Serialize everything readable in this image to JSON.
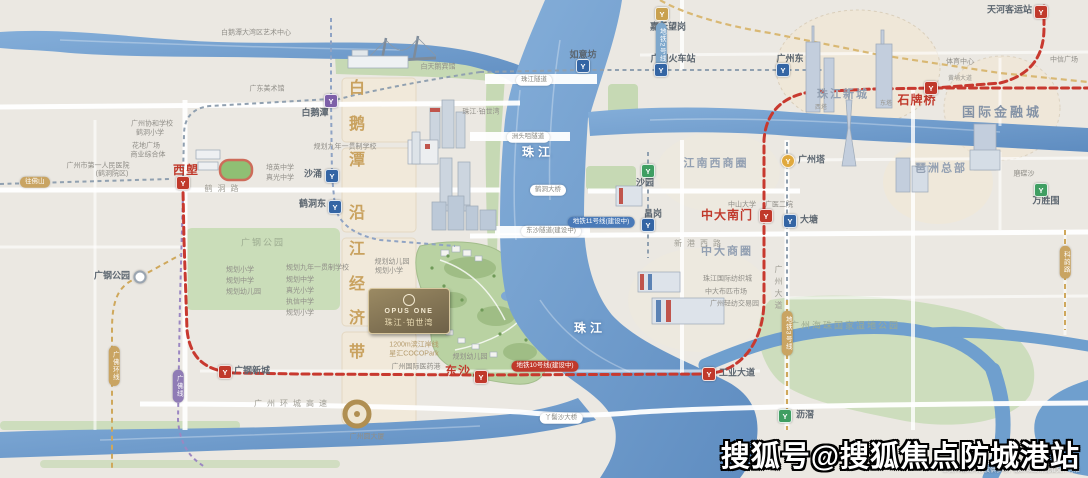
{
  "watermark": {
    "text": "搜狐号@搜狐焦点防城港站",
    "disclaimer": "本资料相关内容仅供参考，最终以政府批准文件为准"
  },
  "project": {
    "logo_latin": "OPUS ONE",
    "logo_cn": "珠江·铂世湾"
  },
  "icon_glyph": "Y",
  "colors": {
    "metro_red": "#c0392b",
    "metro_blue": "#3465a4",
    "metro_gold": "#c9a14e",
    "metro_purple": "#7d5fa8",
    "river_blue": "#6f9cce",
    "park_green": "#c6d9b4",
    "district_gold": "#c9a25f"
  },
  "stations": [
    {
      "x": 183,
      "y": 183,
      "c": "ic-red",
      "n": "station-icon-xilang"
    },
    {
      "x": 225,
      "y": 372,
      "c": "ic-red",
      "n": "station-icon-guanggang-xincheng"
    },
    {
      "x": 481,
      "y": 377,
      "c": "ic-red",
      "n": "station-icon-dongsha"
    },
    {
      "x": 709,
      "y": 374,
      "c": "ic-red",
      "n": "station-icon-gongye-dadao"
    },
    {
      "x": 766,
      "y": 216,
      "c": "ic-red",
      "n": "station-icon-zhongda-nanmen"
    },
    {
      "x": 931,
      "y": 88,
      "c": "ic-red",
      "n": "station-icon-shipaiqiao"
    },
    {
      "x": 1041,
      "y": 12,
      "c": "ic-red",
      "n": "station-icon-tianhe-keyunzhan"
    },
    {
      "x": 331,
      "y": 101,
      "c": "ic-purple",
      "n": "station-icon-baietan"
    },
    {
      "x": 332,
      "y": 176,
      "c": "ic-blue",
      "n": "station-icon-shachong"
    },
    {
      "x": 335,
      "y": 207,
      "c": "ic-blue",
      "n": "station-icon-hedongdong"
    },
    {
      "x": 583,
      "y": 66,
      "c": "ic-blue",
      "n": "station-icon-ruyifang"
    },
    {
      "x": 661,
      "y": 70,
      "c": "ic-blue",
      "n": "station-icon-guangzhou-railway"
    },
    {
      "x": 662,
      "y": 14,
      "c": "ic-gold",
      "n": "station-icon-jiahewanggang"
    },
    {
      "x": 783,
      "y": 70,
      "c": "ic-blue",
      "n": "station-icon-guangzhoudong"
    },
    {
      "x": 788,
      "y": 161,
      "c": "ic-yellow",
      "n": "station-icon-canton-tower"
    },
    {
      "x": 790,
      "y": 221,
      "c": "ic-blue",
      "n": "station-icon-datang"
    },
    {
      "x": 648,
      "y": 171,
      "c": "ic-green",
      "n": "station-icon-shayuan"
    },
    {
      "x": 648,
      "y": 225,
      "c": "ic-blue",
      "n": "station-icon-changgang"
    },
    {
      "x": 785,
      "y": 416,
      "c": "ic-green",
      "n": "station-icon-lijiao"
    },
    {
      "x": 1041,
      "y": 190,
      "c": "ic-green",
      "n": "station-icon-wanshengwei"
    },
    {
      "x": 140,
      "y": 277,
      "c": "ic-ring",
      "n": "station-icon-guanggang-park"
    }
  ],
  "labels": [
    {
      "t": "西塱",
      "x": 186,
      "y": 170,
      "c": "sta-red",
      "n": "station-label-xilang"
    },
    {
      "t": "广钢新城",
      "x": 234,
      "y": 371,
      "c": "sta",
      "a": "l",
      "n": "station-label-guanggang-xincheng"
    },
    {
      "t": "东沙",
      "x": 471,
      "y": 371,
      "c": "sta-red",
      "a": "r",
      "n": "station-label-dongsha"
    },
    {
      "t": "工业大道",
      "x": 719,
      "y": 373,
      "c": "sta",
      "a": "l",
      "n": "station-label-gongye-dadao"
    },
    {
      "t": "中大南门",
      "x": 753,
      "y": 215,
      "c": "sta-red",
      "a": "r",
      "n": "station-label-zhongda-nanmen"
    },
    {
      "t": "石牌桥",
      "x": 917,
      "y": 100,
      "c": "sta-red",
      "n": "station-label-shipaiqiao"
    },
    {
      "t": "天河客运站",
      "x": 1032,
      "y": 10,
      "c": "sta",
      "a": "r",
      "n": "station-label-tianhe-keyunzhan"
    },
    {
      "t": "白鹅潭",
      "x": 315,
      "y": 113,
      "c": "sta",
      "n": "station-label-baietan"
    },
    {
      "t": "沙涌",
      "x": 322,
      "y": 174,
      "c": "sta",
      "a": "r",
      "n": "station-label-shachong"
    },
    {
      "t": "鹤洞东",
      "x": 326,
      "y": 204,
      "c": "sta",
      "a": "r",
      "n": "station-label-hedongdong"
    },
    {
      "t": "如意坊",
      "x": 583,
      "y": 55,
      "c": "sta",
      "n": "station-label-ruyifang"
    },
    {
      "t": "广州火车站",
      "x": 673,
      "y": 59,
      "c": "sta",
      "n": "station-label-guangzhou-railway"
    },
    {
      "t": "嘉禾望岗",
      "x": 668,
      "y": 27,
      "c": "sta",
      "n": "station-label-jiahewanggang"
    },
    {
      "t": "广州东",
      "x": 790,
      "y": 59,
      "c": "sta",
      "n": "station-label-guangzhoudong"
    },
    {
      "t": "广州塔",
      "x": 798,
      "y": 160,
      "c": "sta",
      "a": "l",
      "n": "station-label-canton-tower"
    },
    {
      "t": "大塘",
      "x": 800,
      "y": 220,
      "c": "sta",
      "a": "l",
      "n": "station-label-datang"
    },
    {
      "t": "沙园",
      "x": 645,
      "y": 183,
      "c": "sta",
      "n": "station-label-shayuan"
    },
    {
      "t": "昌岗",
      "x": 653,
      "y": 214,
      "c": "sta",
      "n": "station-label-changgang"
    },
    {
      "t": "沥滘",
      "x": 796,
      "y": 415,
      "c": "sta",
      "a": "l",
      "n": "station-label-lijiao"
    },
    {
      "t": "万胜围",
      "x": 1046,
      "y": 201,
      "c": "sta",
      "n": "station-label-wanshengwei"
    },
    {
      "t": "广钢公园",
      "x": 130,
      "y": 276,
      "c": "sta",
      "a": "r",
      "n": "station-label-guanggang-park"
    },
    {
      "t": "江南西商圈",
      "x": 716,
      "y": 164,
      "c": "area-sm",
      "n": "district-label-jiangnanxi"
    },
    {
      "t": "中大商圈",
      "x": 727,
      "y": 252,
      "c": "area-sm",
      "n": "district-label-zhongda"
    },
    {
      "t": "国际金融城",
      "x": 1002,
      "y": 112,
      "c": "area",
      "n": "district-label-financial-city"
    },
    {
      "t": "琶洲总部",
      "x": 941,
      "y": 169,
      "c": "area-sm",
      "n": "district-label-pazhou"
    },
    {
      "t": "珠江新城",
      "x": 843,
      "y": 95,
      "c": "area-sm",
      "n": "district-label-zhujiang-new-town"
    },
    {
      "t": "广州海珠国家湿地公园",
      "x": 845,
      "y": 326,
      "c": "area-green",
      "n": "district-label-haizhu-wetland"
    },
    {
      "t": "广钢公园",
      "x": 263,
      "y": 243,
      "c": "area-green",
      "n": "park-label-guanggang"
    },
    {
      "t": "珠江",
      "x": 538,
      "y": 152,
      "c": "river-t",
      "n": "river-label-pearl-north"
    },
    {
      "t": "珠江",
      "x": 590,
      "y": 328,
      "c": "river-t",
      "n": "river-label-pearl-south"
    },
    {
      "t": "白鹅潭大湾区艺术中心",
      "x": 256,
      "y": 33,
      "c": "t7",
      "n": "poi-label-art-center"
    },
    {
      "t": "广东美术馆",
      "x": 267,
      "y": 89,
      "c": "t7",
      "n": "poi-label-art-museum"
    },
    {
      "t": "广州市第一人民医院",
      "x": 98,
      "y": 166,
      "c": "t7",
      "n": "poi-label-hospital"
    },
    {
      "t": "(鹤洞院区)",
      "x": 112,
      "y": 174,
      "c": "t7",
      "n": "poi-label-hospital-branch"
    },
    {
      "t": "培英中学",
      "x": 266,
      "y": 168,
      "c": "t7",
      "a": "l",
      "n": "poi-label-school-peiying"
    },
    {
      "t": "真光中学",
      "x": 266,
      "y": 178,
      "c": "t7",
      "a": "l",
      "n": "poi-label-school-zhenguang"
    },
    {
      "t": "规划九年一贯制学校",
      "x": 345,
      "y": 147,
      "c": "t7",
      "n": "poi-label-planned-school"
    },
    {
      "t": "广州协和学校",
      "x": 152,
      "y": 124,
      "c": "t7",
      "n": "poi-label-xiehe-school"
    },
    {
      "t": "鹤洞小学",
      "x": 150,
      "y": 133,
      "c": "t7",
      "n": "poi-label-hedong-primary"
    },
    {
      "t": "花地广场",
      "x": 146,
      "y": 146,
      "c": "t7",
      "n": "poi-label-huadi-plaza"
    },
    {
      "t": "商业综合体",
      "x": 148,
      "y": 155,
      "c": "t7",
      "n": "poi-label-commercial-complex"
    },
    {
      "t": "规划幼儿园",
      "x": 392,
      "y": 262,
      "c": "t7",
      "n": "poi-label-planned-kindergarten-1"
    },
    {
      "t": "规划小学",
      "x": 389,
      "y": 271,
      "c": "t7",
      "n": "poi-label-planned-primary-1"
    },
    {
      "t": "规划幼儿园",
      "x": 470,
      "y": 357,
      "c": "t7",
      "n": "poi-label-planned-kindergarten-2"
    },
    {
      "t": "珠江·铂世湾",
      "x": 481,
      "y": 112,
      "c": "t7",
      "n": "poi-label-riverside-project"
    },
    {
      "t": "白天鹅宾馆",
      "x": 438,
      "y": 67,
      "c": "t7",
      "n": "poi-label-white-swan-hotel"
    },
    {
      "t": "规划小学",
      "x": 226,
      "y": 270,
      "c": "t7",
      "a": "l",
      "n": "poi-label-school-list-1"
    },
    {
      "t": "规划中学",
      "x": 226,
      "y": 281,
      "c": "t7",
      "a": "l",
      "n": "poi-label-school-list-2"
    },
    {
      "t": "规划幼儿园",
      "x": 226,
      "y": 292,
      "c": "t7",
      "a": "l",
      "n": "poi-label-school-list-3"
    },
    {
      "t": "规划九年一贯制学校",
      "x": 286,
      "y": 268,
      "c": "t7",
      "a": "l",
      "n": "poi-label-school-list-4"
    },
    {
      "t": "规划中学",
      "x": 286,
      "y": 280,
      "c": "t7",
      "a": "l",
      "n": "poi-label-school-list-5"
    },
    {
      "t": "真光小学",
      "x": 286,
      "y": 291,
      "c": "t7",
      "a": "l",
      "n": "poi-label-school-list-6"
    },
    {
      "t": "执信中学",
      "x": 286,
      "y": 302,
      "c": "t7",
      "a": "l",
      "n": "poi-label-school-list-7"
    },
    {
      "t": "规划小学",
      "x": 286,
      "y": 313,
      "c": "t7",
      "a": "l",
      "n": "poi-label-school-list-8"
    },
    {
      "t": "珠江国际纺织城",
      "x": 703,
      "y": 279,
      "c": "t7",
      "a": "l",
      "n": "poi-label-textile-city"
    },
    {
      "t": "中大布匹市场",
      "x": 705,
      "y": 292,
      "c": "t7",
      "a": "l",
      "n": "poi-label-fabric-market"
    },
    {
      "t": "广州轻纺交易园",
      "x": 710,
      "y": 304,
      "c": "t7",
      "a": "l",
      "n": "poi-label-textile-park"
    },
    {
      "t": "中山大学",
      "x": 742,
      "y": 205,
      "c": "t7",
      "n": "poi-label-sysu"
    },
    {
      "t": "广医二院",
      "x": 779,
      "y": 205,
      "c": "t7",
      "n": "poi-label-gy2-hospital"
    },
    {
      "t": "体育中心",
      "x": 960,
      "y": 62,
      "c": "t7",
      "n": "poi-label-sports-center"
    },
    {
      "t": "中信广场",
      "x": 1064,
      "y": 60,
      "c": "t7",
      "n": "poi-label-citic-plaza"
    },
    {
      "t": "西塔",
      "x": 821,
      "y": 108,
      "c": "t6",
      "n": "poi-label-west-tower"
    },
    {
      "t": "东塔",
      "x": 886,
      "y": 104,
      "c": "t6",
      "n": "poi-label-east-tower"
    },
    {
      "t": "磨碟沙",
      "x": 1024,
      "y": 174,
      "c": "t7",
      "n": "poi-label-modiesha"
    },
    {
      "t": "广州圆大厦",
      "x": 367,
      "y": 437,
      "c": "t7",
      "n": "poi-label-guangzhou-circle"
    },
    {
      "t": "1200m滨江岸线",
      "x": 414,
      "y": 345,
      "c": "tiny-gold",
      "n": "project-note-riverfront"
    },
    {
      "t": "星汇COCOPark",
      "x": 414,
      "y": 354,
      "c": "tiny-gold",
      "n": "project-note-cocopark"
    },
    {
      "t": "广州国际医药港",
      "x": 416,
      "y": 367,
      "c": "t7",
      "n": "poi-label-pharma-port"
    },
    {
      "t": "黄埔大道",
      "x": 960,
      "y": 79,
      "c": "t6",
      "n": "road-label-huangpu-avenue"
    },
    {
      "t": "鹤洞路",
      "x": 224,
      "y": 189,
      "c": "road",
      "n": "road-label-hedong-road"
    },
    {
      "t": "新港西路",
      "x": 700,
      "y": 244,
      "c": "road",
      "n": "road-label-xingangxi-road"
    },
    {
      "t": "广州环城高速",
      "x": 293,
      "y": 404,
      "c": "road",
      "n": "road-label-ring-expressway"
    },
    {
      "t": "广州大道",
      "x": 778,
      "y": 289,
      "c": "road-v",
      "n": "road-label-guangzhou-avenue"
    },
    {
      "t": "白",
      "x": 357,
      "y": 89,
      "c": "gold-ch",
      "n": "district-char-bai"
    },
    {
      "t": "鹅",
      "x": 357,
      "y": 125,
      "c": "gold-ch",
      "n": "district-char-e"
    },
    {
      "t": "潭",
      "x": 357,
      "y": 161,
      "c": "gold-ch",
      "n": "district-char-tan"
    },
    {
      "t": "沿",
      "x": 357,
      "y": 214,
      "c": "gold-ch",
      "n": "district-char-yan"
    },
    {
      "t": "江",
      "x": 357,
      "y": 250,
      "c": "gold-ch",
      "n": "district-char-jiang"
    },
    {
      "t": "经",
      "x": 357,
      "y": 285,
      "c": "gold-ch",
      "n": "district-char-jing"
    },
    {
      "t": "济",
      "x": 357,
      "y": 319,
      "c": "gold-ch",
      "n": "district-char-ji"
    },
    {
      "t": "带",
      "x": 357,
      "y": 353,
      "c": "gold-ch",
      "n": "district-char-dai"
    },
    {
      "t": "珠江隧道",
      "x": 534,
      "y": 80,
      "c": "pill",
      "n": "tunnel-pill-zhujiang"
    },
    {
      "t": "洲头咀隧道",
      "x": 528,
      "y": 137,
      "c": "pill",
      "n": "tunnel-pill-zhoutouzui"
    },
    {
      "t": "鹤洞大桥",
      "x": 548,
      "y": 190,
      "c": "pill",
      "n": "bridge-pill-hedong"
    },
    {
      "t": "东沙隧道(建设中)",
      "x": 551,
      "y": 231,
      "c": "pill",
      "n": "tunnel-pill-dongsha"
    },
    {
      "t": "丫髻沙大桥",
      "x": 561,
      "y": 418,
      "c": "pill",
      "n": "bridge-pill-yajisha"
    },
    {
      "t": "地铁11号线(建设中)",
      "x": 601,
      "y": 222,
      "c": "pill pill-blue",
      "n": "metro-pill-line11"
    },
    {
      "t": "地铁10号线(建设中)",
      "x": 545,
      "y": 366,
      "c": "pill pill-red",
      "n": "metro-pill-line10"
    },
    {
      "t": "往佛山",
      "x": 20,
      "y": 182,
      "c": "pill pill-gold",
      "a": "l",
      "n": "direction-pill-foshan"
    },
    {
      "t": "地铁2号线",
      "x": 661,
      "y": 45,
      "c": "pill pill-lightblue pill-v",
      "n": "metro-pill-line2"
    },
    {
      "t": "广佛线",
      "x": 178,
      "y": 386,
      "c": "pill pill-purple pill-v",
      "n": "metro-pill-guangfo"
    },
    {
      "t": "广佛环线",
      "x": 114,
      "y": 366,
      "c": "pill pill-gold pill-v",
      "n": "rail-pill-guangfo-loop"
    },
    {
      "t": "地铁3号线",
      "x": 787,
      "y": 333,
      "c": "pill pill-gold pill-v",
      "n": "metro-pill-line3"
    },
    {
      "t": "科韵路",
      "x": 1065,
      "y": 262,
      "c": "pill pill-gold pill-v",
      "n": "road-pill-keyun"
    },
    {
      "t": "本资料相关内容仅供参考，最终以政府批准文件为准",
      "x": 1080,
      "y": 471,
      "c": "disc",
      "a": "r",
      "n": "disclaimer-text"
    }
  ]
}
